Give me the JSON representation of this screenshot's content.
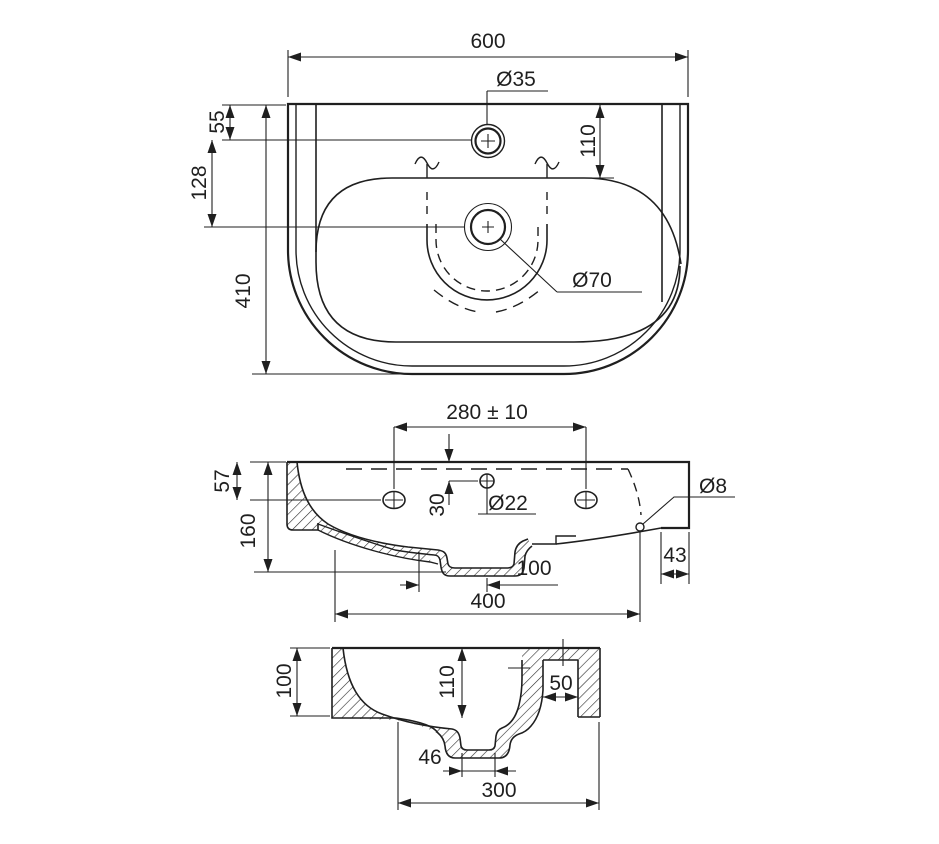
{
  "top": {
    "width": "600",
    "faucet_dia": "Ø35",
    "rim_to_faucet": "55",
    "deck_to_bowl": "110",
    "faucet_to_drain": "128",
    "depth": "410",
    "drain_dia": "Ø70"
  },
  "front": {
    "bolt_spacing": "280 ± 10",
    "rim_to_overflow": "30",
    "overflow_dia": "Ø22",
    "fixing_hole_dia": "Ø8",
    "rim_height": "57",
    "total_height": "160",
    "drain_offset": "100",
    "drain_span": "400",
    "wall_offset": "43"
  },
  "section": {
    "rim_height": "100",
    "bowl_depth": "110",
    "channel_width": "50",
    "trap_width": "46",
    "bowl_span": "300"
  },
  "colors": {
    "line": "#1f1f1f",
    "background": "#ffffff"
  }
}
